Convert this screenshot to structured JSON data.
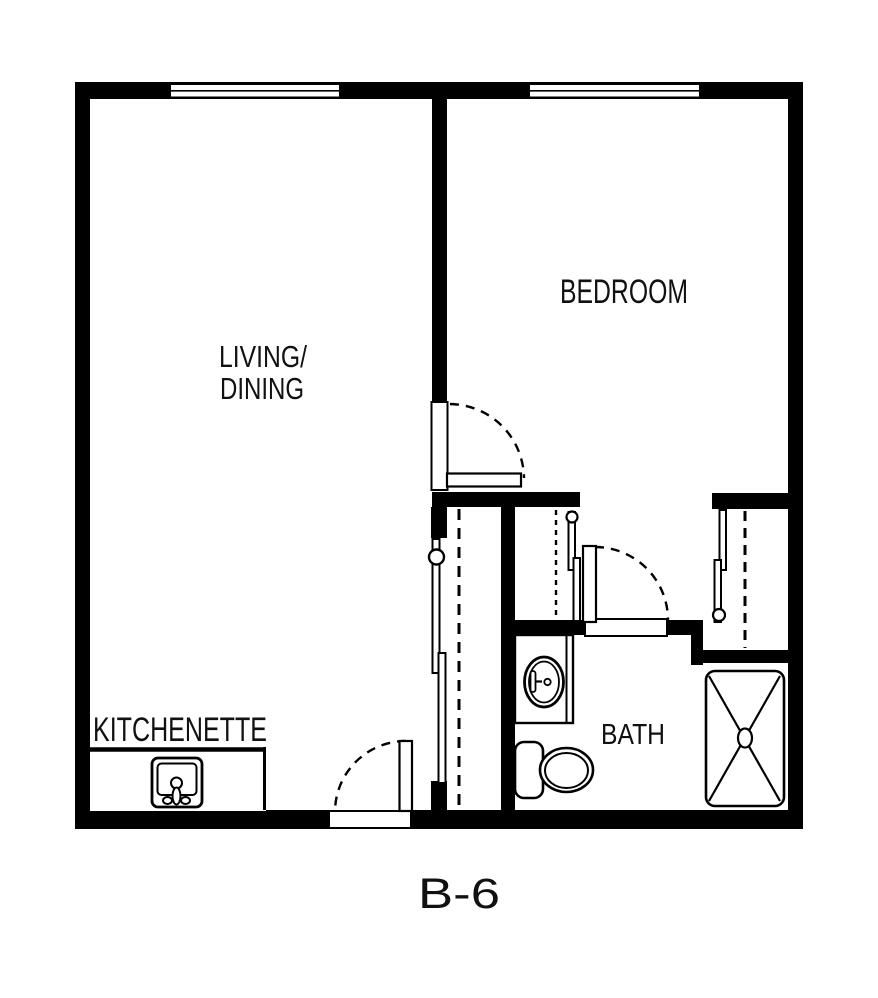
{
  "page": {
    "background": "#ffffff"
  },
  "floor_plan": {
    "unit_label": "B-6",
    "rooms": {
      "living_dining": {
        "line1": "LIVING/",
        "line2": "DINING"
      },
      "bedroom": {
        "label": "BEDROOM"
      },
      "kitchenette": {
        "label": "KITCHENETTE"
      },
      "bath": {
        "label": "BATH"
      }
    },
    "windows": [
      "living-window-top-wall",
      "bedroom-window-top-wall"
    ],
    "doors": {
      "entry": "hinged-door-in-bottom-wall-swing-left",
      "bedroom": "hinged-door-living-to-bedroom-swing-right",
      "bath": "hinged-door-hall-to-bath-swing-right",
      "living_closet": "sliding-bypass-doors-with-pull",
      "hall_closet": "sliding-bypass-doors-with-pull",
      "bedroom_closet": "sliding-bypass-doors-with-pull"
    },
    "fixtures": {
      "kitchen_sink": "kitchen-sink-with-faucet",
      "bath_vanity": "vanity-counter",
      "bath_sink": "oval-lavatory-sink",
      "toilet": "toilet-tank-and-bowl",
      "shower": "shower-pan-with-x",
      "closet_rods": "dashed-closet-rod-lines"
    },
    "colors": {
      "wall": "#000000",
      "floor": "#ffffff",
      "text": "#111111"
    }
  }
}
